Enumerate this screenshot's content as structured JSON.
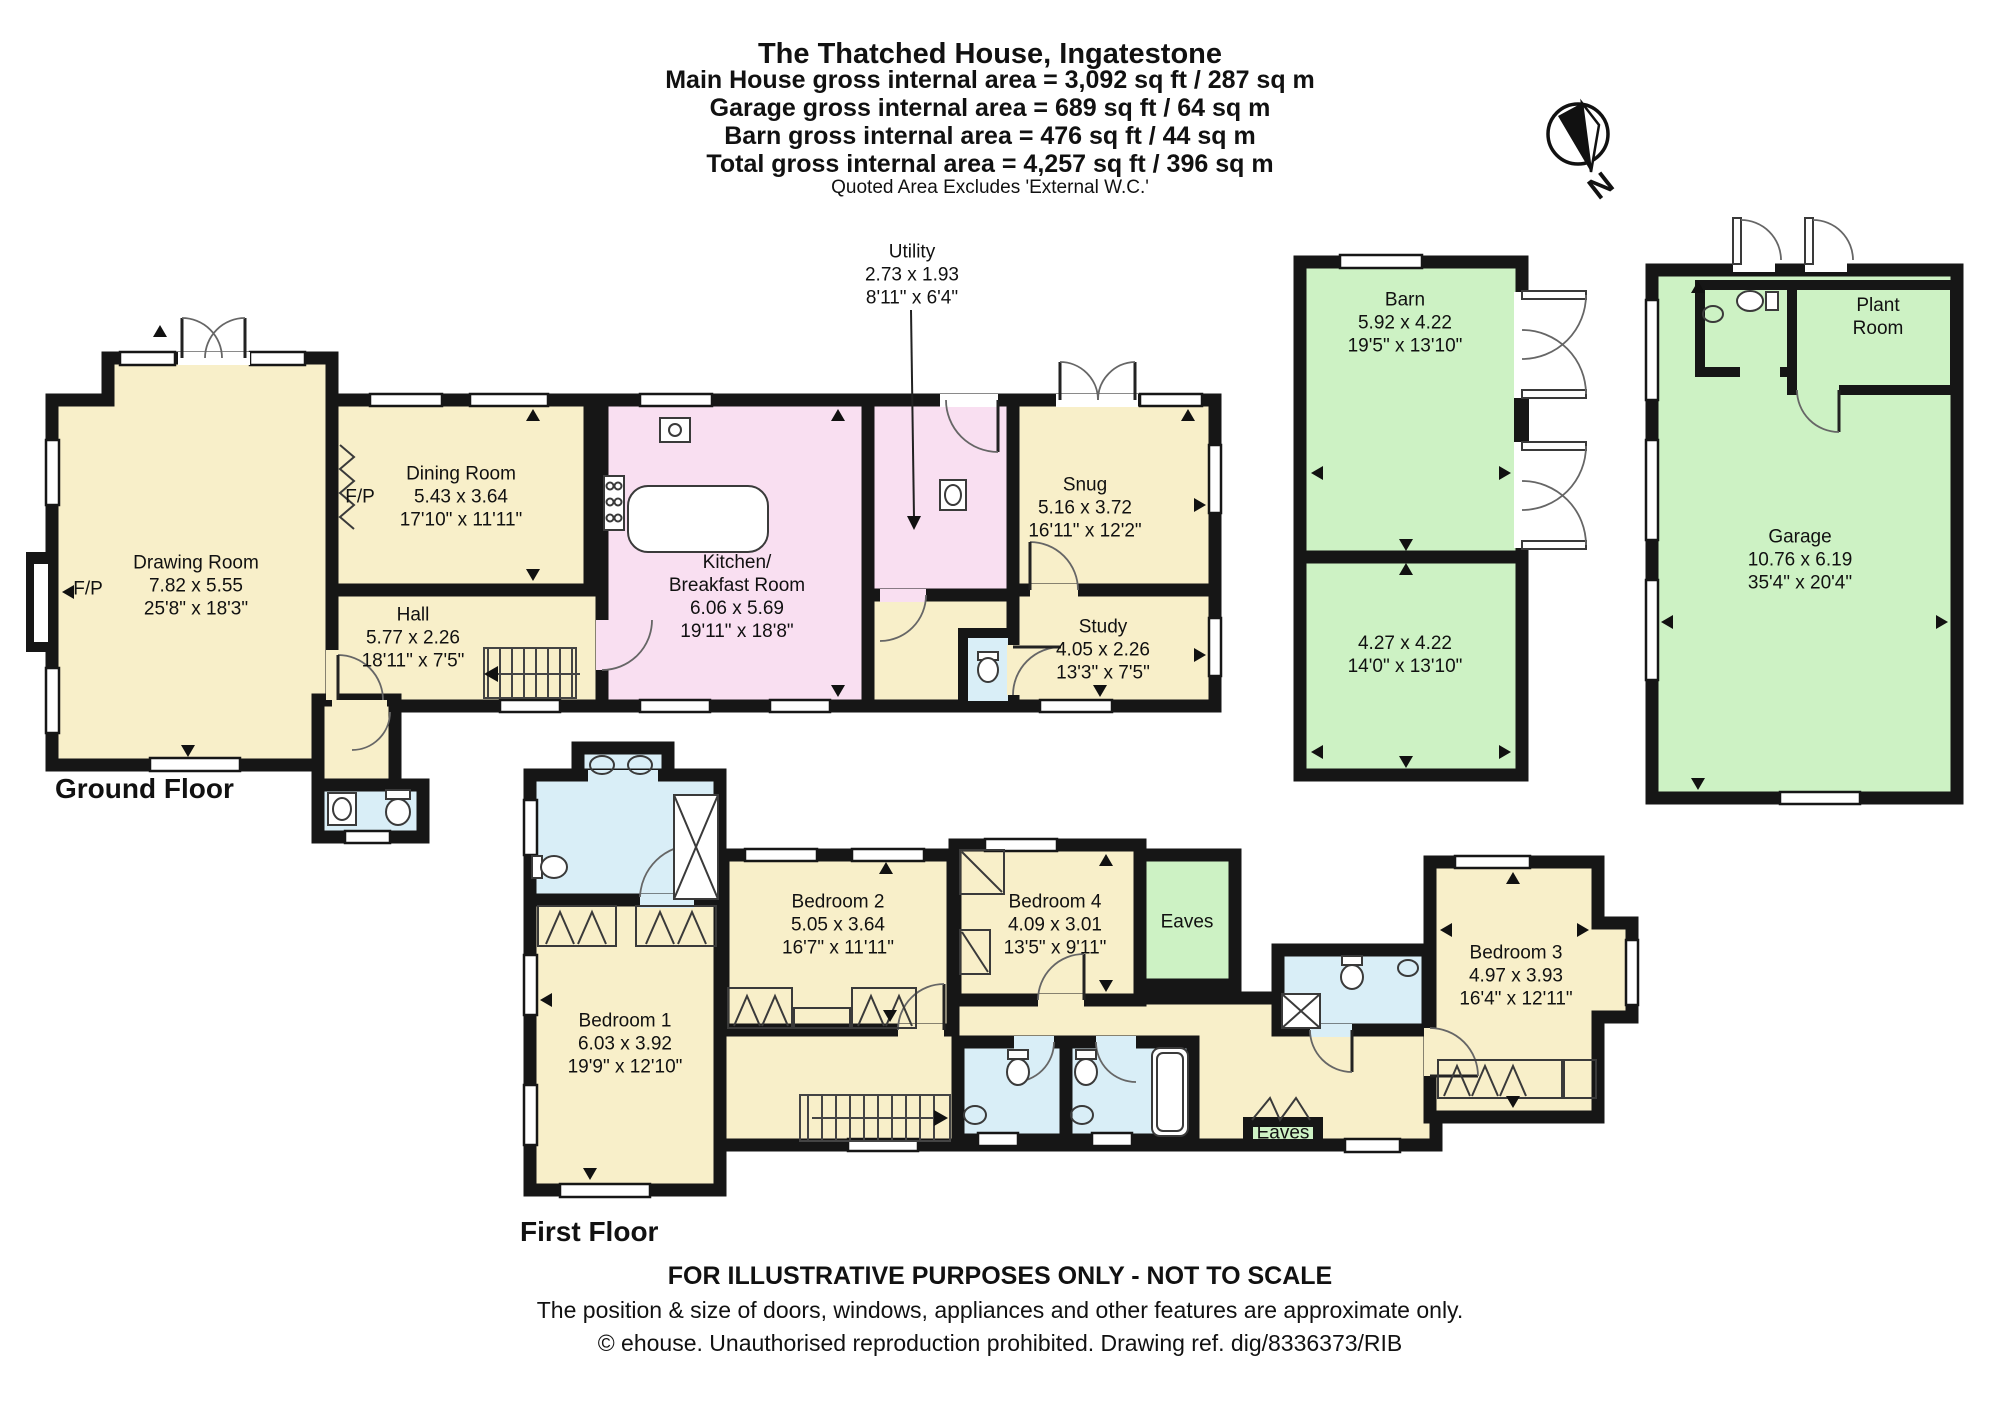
{
  "palette": {
    "wall": "#161616",
    "cream": "#f8efc9",
    "pink": "#f9dff1",
    "green": "#cdf2c4",
    "blue": "#d9eef7",
    "page": "#ffffff"
  },
  "header": {
    "title": "The Thatched House, Ingatestone",
    "area_lines": [
      "Main House gross internal area = 3,092 sq ft / 287 sq m",
      "Garage gross internal area = 689 sq ft / 64 sq m",
      "Barn gross internal area = 476 sq ft / 44 sq m",
      "Total gross internal area = 4,257 sq ft / 396 sq m"
    ],
    "note": "Quoted Area Excludes 'External W.C.'"
  },
  "compass": {
    "label": "N"
  },
  "floor_labels": {
    "ground": "Ground Floor",
    "first": "First Floor"
  },
  "rooms": {
    "drawing_room": {
      "name": "Drawing Room",
      "metric": "7.82 x 5.55",
      "imperial": "25'8\" x 18'3\""
    },
    "dining_room": {
      "name": "Dining Room",
      "metric": "5.43 x 3.64",
      "imperial": "17'10\" x 11'11\""
    },
    "hall": {
      "name": "Hall",
      "metric": "5.77 x 2.26",
      "imperial": "18'11\" x 7'5\""
    },
    "kitchen": {
      "name_line1": "Kitchen/",
      "name_line2": "Breakfast Room",
      "metric": "6.06 x 5.69",
      "imperial": "19'11\" x 18'8\""
    },
    "utility": {
      "name": "Utility",
      "metric": "2.73 x 1.93",
      "imperial": "8'11\" x 6'4\""
    },
    "snug": {
      "name": "Snug",
      "metric": "5.16 x 3.72",
      "imperial": "16'11\" x 12'2\""
    },
    "study": {
      "name": "Study",
      "metric": "4.05 x 2.26",
      "imperial": "13'3\" x 7'5\""
    },
    "barn": {
      "name": "Barn",
      "metric": "5.92 x 4.22",
      "imperial": "19'5\" x 13'10\""
    },
    "barn_store": {
      "metric": "4.27 x 4.22",
      "imperial": "14'0\" x 13'10\""
    },
    "garage": {
      "name": "Garage",
      "metric": "10.76 x 6.19",
      "imperial": "35'4\" x 20'4\""
    },
    "plant_room": {
      "name_line1": "Plant",
      "name_line2": "Room"
    },
    "bedroom1": {
      "name": "Bedroom 1",
      "metric": "6.03 x 3.92",
      "imperial": "19'9\" x 12'10\""
    },
    "bedroom2": {
      "name": "Bedroom 2",
      "metric": "5.05 x 3.64",
      "imperial": "16'7\" x 11'11\""
    },
    "bedroom3": {
      "name": "Bedroom 3",
      "metric": "4.97 x 3.93",
      "imperial": "16'4\" x 12'11\""
    },
    "bedroom4": {
      "name": "Bedroom 4",
      "metric": "4.09 x 3.01",
      "imperial": "13'5\" x 9'11\""
    }
  },
  "annotations": {
    "fireplace": "F/P",
    "eaves": "Eaves"
  },
  "footer": {
    "line1": "FOR ILLUSTRATIVE PURPOSES ONLY - NOT TO SCALE",
    "line2": "The position & size of doors, windows, appliances and other features are approximate only.",
    "line3": "© ehouse. Unauthorised reproduction prohibited. Drawing ref. dig/8336373/RIB"
  }
}
